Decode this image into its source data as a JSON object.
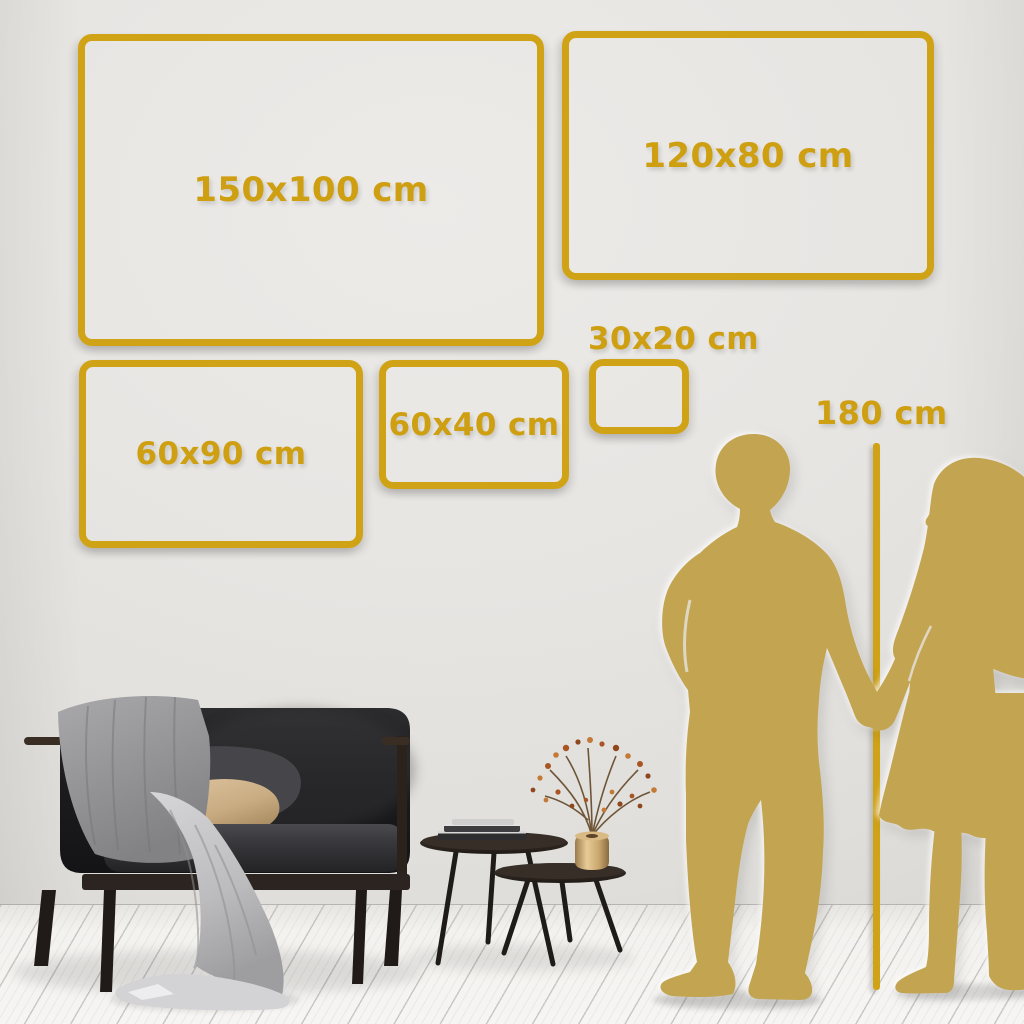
{
  "size_guide": {
    "frames": [
      {
        "id": "150x100",
        "label": "150x100 cm",
        "label_position": "inside"
      },
      {
        "id": "120x80",
        "label": "120x80 cm",
        "label_position": "inside"
      },
      {
        "id": "60x90",
        "label": "60x90 cm",
        "label_position": "inside"
      },
      {
        "id": "60x40",
        "label": "60x40 cm",
        "label_position": "inside"
      },
      {
        "id": "30x20",
        "label": "30x20 cm",
        "label_position": "above"
      }
    ],
    "height_reference": {
      "label": "180 cm"
    }
  },
  "palette": {
    "accent_gold": "#d0a317",
    "silhouette_gold": "#c3a451",
    "wall": "#e6e4e1",
    "floor": "#f3f2f0"
  },
  "scene_objects": [
    "sofa",
    "throw-blanket",
    "dark-cushion",
    "beige-cushion",
    "nesting-coffee-tables",
    "stacked-books",
    "brass-vase-with-dried-branch",
    "man-silhouette",
    "woman-silhouette",
    "height-reference-line"
  ]
}
